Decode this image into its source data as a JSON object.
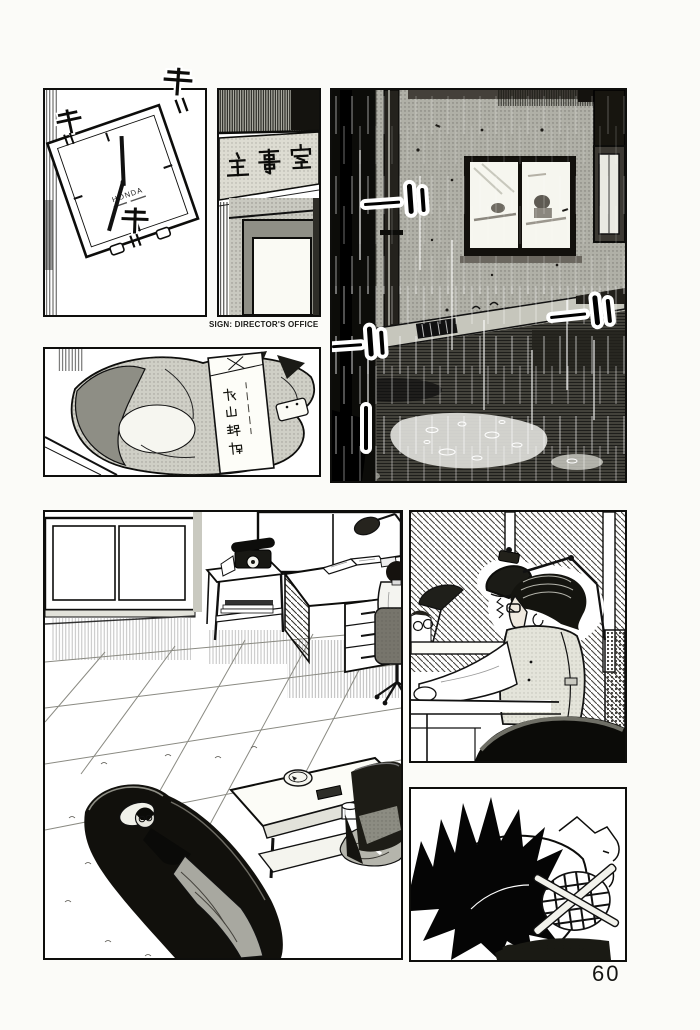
{
  "page": {
    "number": "60"
  },
  "panels": {
    "clock": {
      "brand": "HONDA",
      "sfx_char": "干",
      "sfx_tick": "〃"
    },
    "director_office_door": {
      "sign": "主事室",
      "caption": "SIGN: DIRECTOR'S OFFICE"
    },
    "envelope": {
      "name": "秋山瑞穂"
    }
  }
}
